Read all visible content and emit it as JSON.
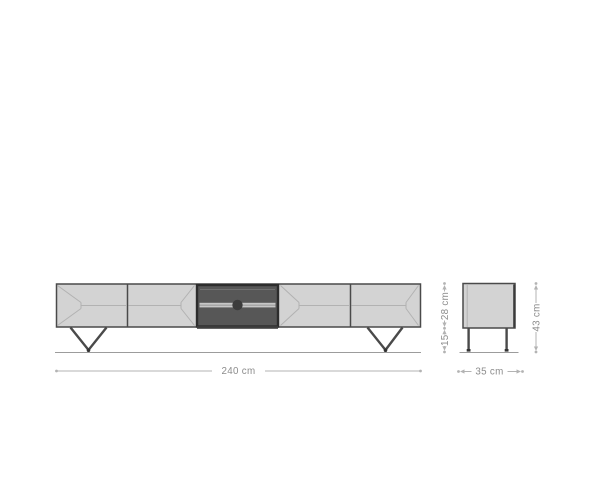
{
  "diagram": {
    "subject": "tv-lowboard-dimension-drawing",
    "front_view": {
      "door_count": 4,
      "width_label": "240 cm"
    },
    "side_view": {
      "depth_label": "35 cm",
      "body_height_label": "28 cm",
      "leg_height_label": "15",
      "total_height_label": "43 cm"
    }
  },
  "colors": {
    "background": "#ffffff",
    "body_fill": "#d3d3d3",
    "body_outline": "#4a4a4a",
    "bevel_line": "#b2b2b2",
    "compartment_fill": "#575757",
    "compartment_frame": "#2d2d2d",
    "shelf_line": "#c6c6c6",
    "knob": "#3c3c3c",
    "ground_line": "#9c9c9c",
    "dimension_line": "#b3b3b3",
    "dimension_text": "#8c8c8c"
  }
}
